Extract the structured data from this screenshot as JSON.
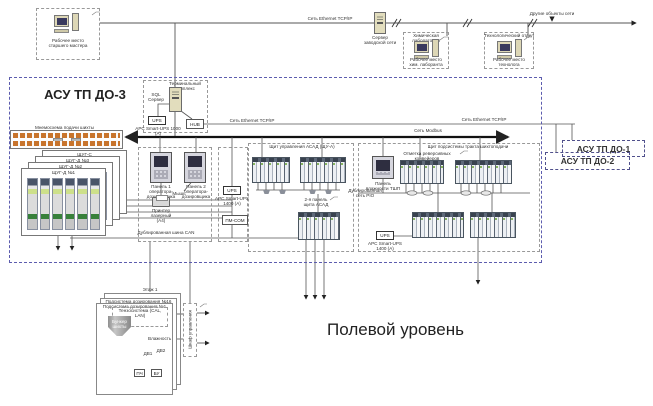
{
  "network": {
    "ethernet": "Сеть Ethernet TCP/IP",
    "modbus": "Сеть Modbus",
    "can": "Дублированная шина CAN",
    "pio": "Дублированная сеть PIO",
    "other_objects": "Другие объекты сети"
  },
  "plant_level": {
    "master_ws": "Рабочее место\nстаршего мастера",
    "server": "Сервер\nзаводской сети",
    "chem_lab": "Химическая лаборатория",
    "chem_ws": "Рабочее место\nхим. лаборанта",
    "tech_dept": "Технологический отдел",
    "tech_ws": "Рабочее место\nтехнолога"
  },
  "asu_do3": {
    "title": "АСУ ТП ДО-3",
    "terminal": {
      "title": "Терминальный\nкомплекс",
      "server": "SQL\nСервер",
      "ups": "UPS",
      "ups_model": "APC Smart-UPS 1000 (А)",
      "hub": "HUB"
    },
    "mimic": "Мнемосхема подачи шихты",
    "cabinets": [
      "ЩУГ-С",
      "ЩУГ-Д №3",
      "ЩУГ-Д №2",
      "ЩУГ-Д №1"
    ],
    "operators": {
      "panel1": "Панель 1\nоператора-\nдозировщика",
      "panel2": "Панель 2\nоператора-\nдозировщика",
      "mouse": "Мышь",
      "printer": "Принтер лазерный\n(А4)"
    },
    "ups_mid": "UPS",
    "ups_mid_model": "APC Smart-UPS 1400 (А)",
    "gateway": "ПМ-СОМ",
    "asad": {
      "title": "Щит управления АСАД (ЩУ-А)",
      "panel2": "2-я панель\nщита АСАД"
    },
    "tshp": {
      "title": "Щит подсистемы тракта шихтоподачи",
      "note": "Отметка реверсивных конвейеров",
      "panel": "Панель\nвлажности ТШП",
      "ups": "UPS",
      "ups_model": "APC Smart-UPS 1400 (А)"
    }
  },
  "neighbors": {
    "do1": "АСУ ТП ДО-1",
    "do2": "АСУ ТП ДО-2"
  },
  "field_level": {
    "title": "Полевой уровень",
    "floor": "Этаж 1",
    "subsystem16": "Подсистема дозирования №16",
    "subsystem1": "Подсистема дозирования №1",
    "tenso": "Тензосистема (CAL, LAN)",
    "hopper": "Бункер\nшихты",
    "moisture": "Влажность",
    "motor_left": "ДВ1",
    "motor_right": "ДВ2",
    "freq_conv": "ПЧ",
    "control_unit": "БУ",
    "motor": "М",
    "cabinet": "Шкаф управления"
  },
  "colors": {
    "region_dashed": "#5c5cae",
    "modbus_line": "#111111",
    "mimic_module": "#c8742c"
  }
}
